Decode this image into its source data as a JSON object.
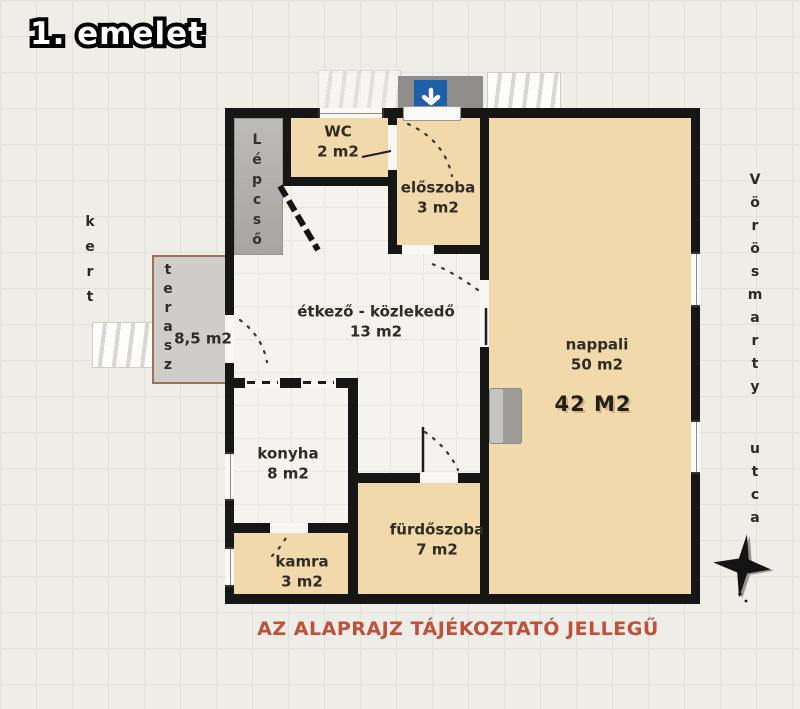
{
  "title": "1. emelet",
  "disclaimer": "AZ ALAPRAJZ TÁJÉKOZTATÓ JELLEGŰ",
  "surroundings": {
    "left_label": "kert",
    "right_label": "Vörösmarty utca"
  },
  "rooms": [
    {
      "name": "WC",
      "area": "2 m2"
    },
    {
      "name": "előszoba",
      "area": "3 m2"
    },
    {
      "name": "étkező - közlekedő",
      "area": "13 m2"
    },
    {
      "name": "nappali",
      "area": "50 m2",
      "area_alt": "42 M2"
    },
    {
      "name": "konyha",
      "area": "8 m2"
    },
    {
      "name": "fürdőszoba",
      "area": "7 m2"
    },
    {
      "name": "kamra",
      "area": "3 m2"
    },
    {
      "name": "Lépcső",
      "area": ""
    },
    {
      "name": "terasz",
      "area": "8,5 m2"
    }
  ],
  "icons": {
    "entrance": "down-arrow-icon",
    "compass": "compass-rose-icon"
  },
  "colors": {
    "room_fill": "#f1d9ab",
    "wall": "#161616",
    "disclaimer_text": "#c0503a",
    "entrance_blue": "#1f5ea8",
    "stairs_gray": "#b3b1ae",
    "terrace_gray": "#cecdc9"
  }
}
